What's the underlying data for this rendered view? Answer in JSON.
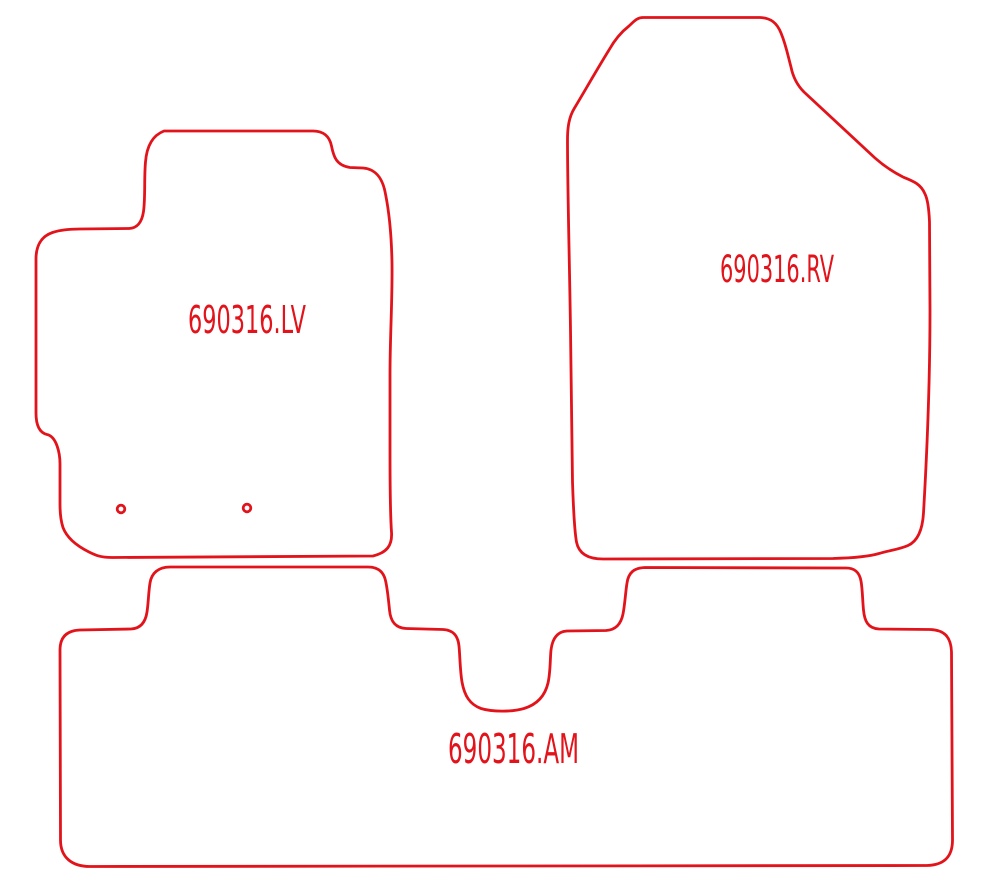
{
  "drawing": {
    "type": "cad-cutting-pattern",
    "colors": {
      "background": "#ffffff",
      "outline": "#e2131a"
    },
    "stroke_width": "2.8px",
    "labels": {
      "lv": "690316.LV",
      "rv": "690316.RV",
      "am": "690316.AM"
    },
    "holes": [
      {
        "x": 121,
        "y": 509,
        "r": 3.8
      },
      {
        "x": 247,
        "y": 508,
        "r": 3.8
      }
    ],
    "paths": {
      "lv": "M 164 131 L 313 131 C 323 131 329.5 136 331.5 146 C 333.5 156 336 165.5 350 167.5 L 363 168 C 375 169 382.5 177 385.5 194 C 389.5 214 391.5 236 392 263 C 392.5 300 390 335 390 375 L 390 450 C 390 485 390.5 518 391.5 532 C 392.5 546 386.5 552.5 373 556 L 112 557.5 C 101 557.5 96 555.5 89 552 C 80 547.5 67.5 539.5 63 527.5 C 61 521.5 60 514 60 504 L 60 464 C 60 453 56.5 436.5 47 434.5 C 38.5 432.5 36 424 36 413 L 36 259 C 36 247 40.5 236.5 52.5 232.5 C 60 230 68 229 80 229 L 129 228.5 C 138 228 142 221.5 143.5 211.5 C 145.5 197.5 144 178 145.5 162 C 146.5 149 151 136 164 131 Z",
      "rv": "M 643 17.5 L 760 17.5 C 771 18 777 23 781 33 C 786 45 788 56 791 67 C 793 77 797 85 804 92 L 875 158 C 884 166 893 172 903 177 C 913 181 921 184 925 194 C 928 200 929 210 929.5 222 L 930 310 C 930 390 926 470 923.5 513 C 922.5 530 918 541 908 545.5 C 899 549.5 889 550.5 879 553.5 C 869 556.5 852 558 833 558.5 L 603 559 C 590 559 579 555 576.5 542 C 574.5 531 573.5 512 572.5 482 L 570.5 330 C 569.5 260 567.5 190 567.5 140 C 567.5 127 569 117 574.5 108 C 583 94 596 71 609 50 C 614 41 620 33 629 26 C 634 21.5 637 17.5 643 17.5 Z",
      "am": "M 170 567 L 368 567 C 378 567 383.5 571.5 385.5 580.5 C 387.5 589 388.5 600 389.5 610 C 390.5 621 395 628 406 628.5 L 443 629.5 C 453 630 458 635.5 459 646 C 460 656 460 670 462 682 C 464.5 696 470 704.5 481 708.5 C 492 712 512 712 524 708.5 C 537 704.5 545 696 548 683 C 550.5 672 550 660 551 650 C 552.5 638 557.5 631.5 567 631 L 606 630.5 C 616 630 621 624 623 614 C 625 604 625.5 592 627 583 C 628.5 572.5 634 568 645 567.5 L 846 568 C 855 568 859.5 572.5 861 581 C 862.5 589 862.5 600 863.5 610 C 864.5 621 868 628.5 879 629 L 930 629.5 C 944 630 951 636.5 951.5 652 L 952.5 840 C 952.5 856.5 944.5 865 927 865.5 L 90 866.5 C 72.5 866.5 60.5 858 60.5 840 L 60 650 C 60 637.5 66.5 630.5 80 630 L 131 629 C 141 628.5 145.5 622 147 612 C 148.5 602 148.5 592 150 583 C 151.5 573 158.5 567 170 567 Z",
      "holes": "M 117.2 509 a 3.8 3.8 0 1 0 7.6 0 a 3.8 3.8 0 1 0 -7.6 0 M 243.2 508 a 3.8 3.8 0 1 0 7.6 0 a 3.8 3.8 0 1 0 -7.6 0"
    }
  }
}
